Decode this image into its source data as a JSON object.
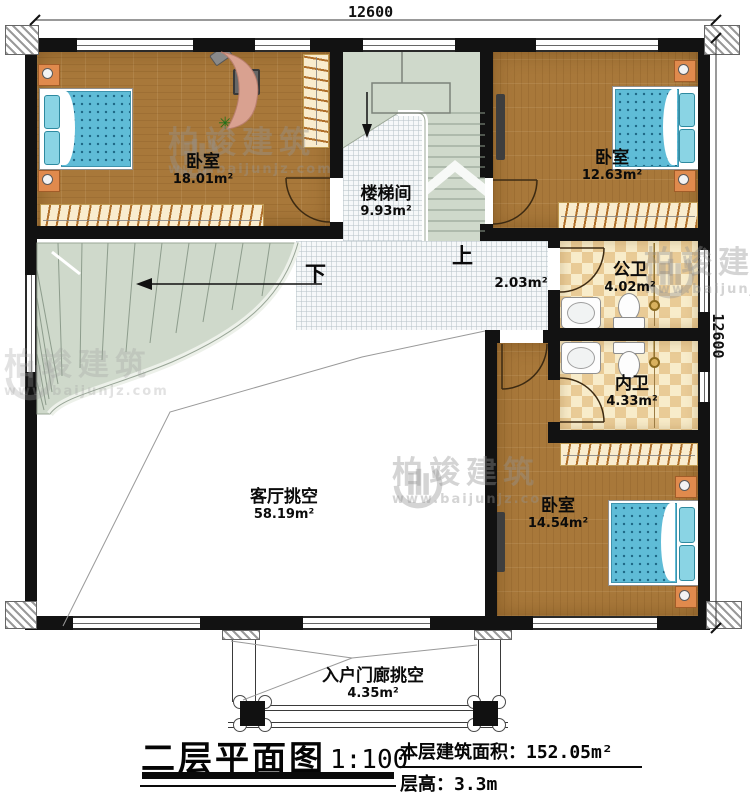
{
  "dimensions": {
    "top": "12600",
    "right": "12600"
  },
  "rooms": {
    "bedroom1": {
      "name": "卧室",
      "area": "18.01m²"
    },
    "stairwell": {
      "name": "楼梯间",
      "area": "9.93m²"
    },
    "bedroom2": {
      "name": "卧室",
      "area": "12.63m²"
    },
    "public_bath": {
      "name": "公卫",
      "area": "4.02m²"
    },
    "inner_bath": {
      "name": "内卫",
      "area": "4.33m²"
    },
    "bedroom3": {
      "name": "卧室",
      "area": "14.54m²"
    },
    "living_void": {
      "name": "客厅挑空",
      "area": "58.19m²"
    },
    "hall": {
      "area": "2.03m²"
    },
    "porch_void": {
      "name": "入户门廊挑空",
      "area": "4.35m²"
    }
  },
  "stairs": {
    "up_label": "上",
    "down_label": "下"
  },
  "titleblock": {
    "title": "二层平面图",
    "scale": "1:100",
    "floor_area": "本层建筑面积：152.05m²",
    "floor_height": "层高：3.3m"
  },
  "watermark": {
    "brand": "柏竣建筑",
    "url": "www.baijunjz.com"
  },
  "colors": {
    "wall": "#121212",
    "wood": "#a8783a",
    "stair": "#cfd9cb",
    "tile_checker": "#e9cb96",
    "bed_blue": "#5fbcd7"
  }
}
